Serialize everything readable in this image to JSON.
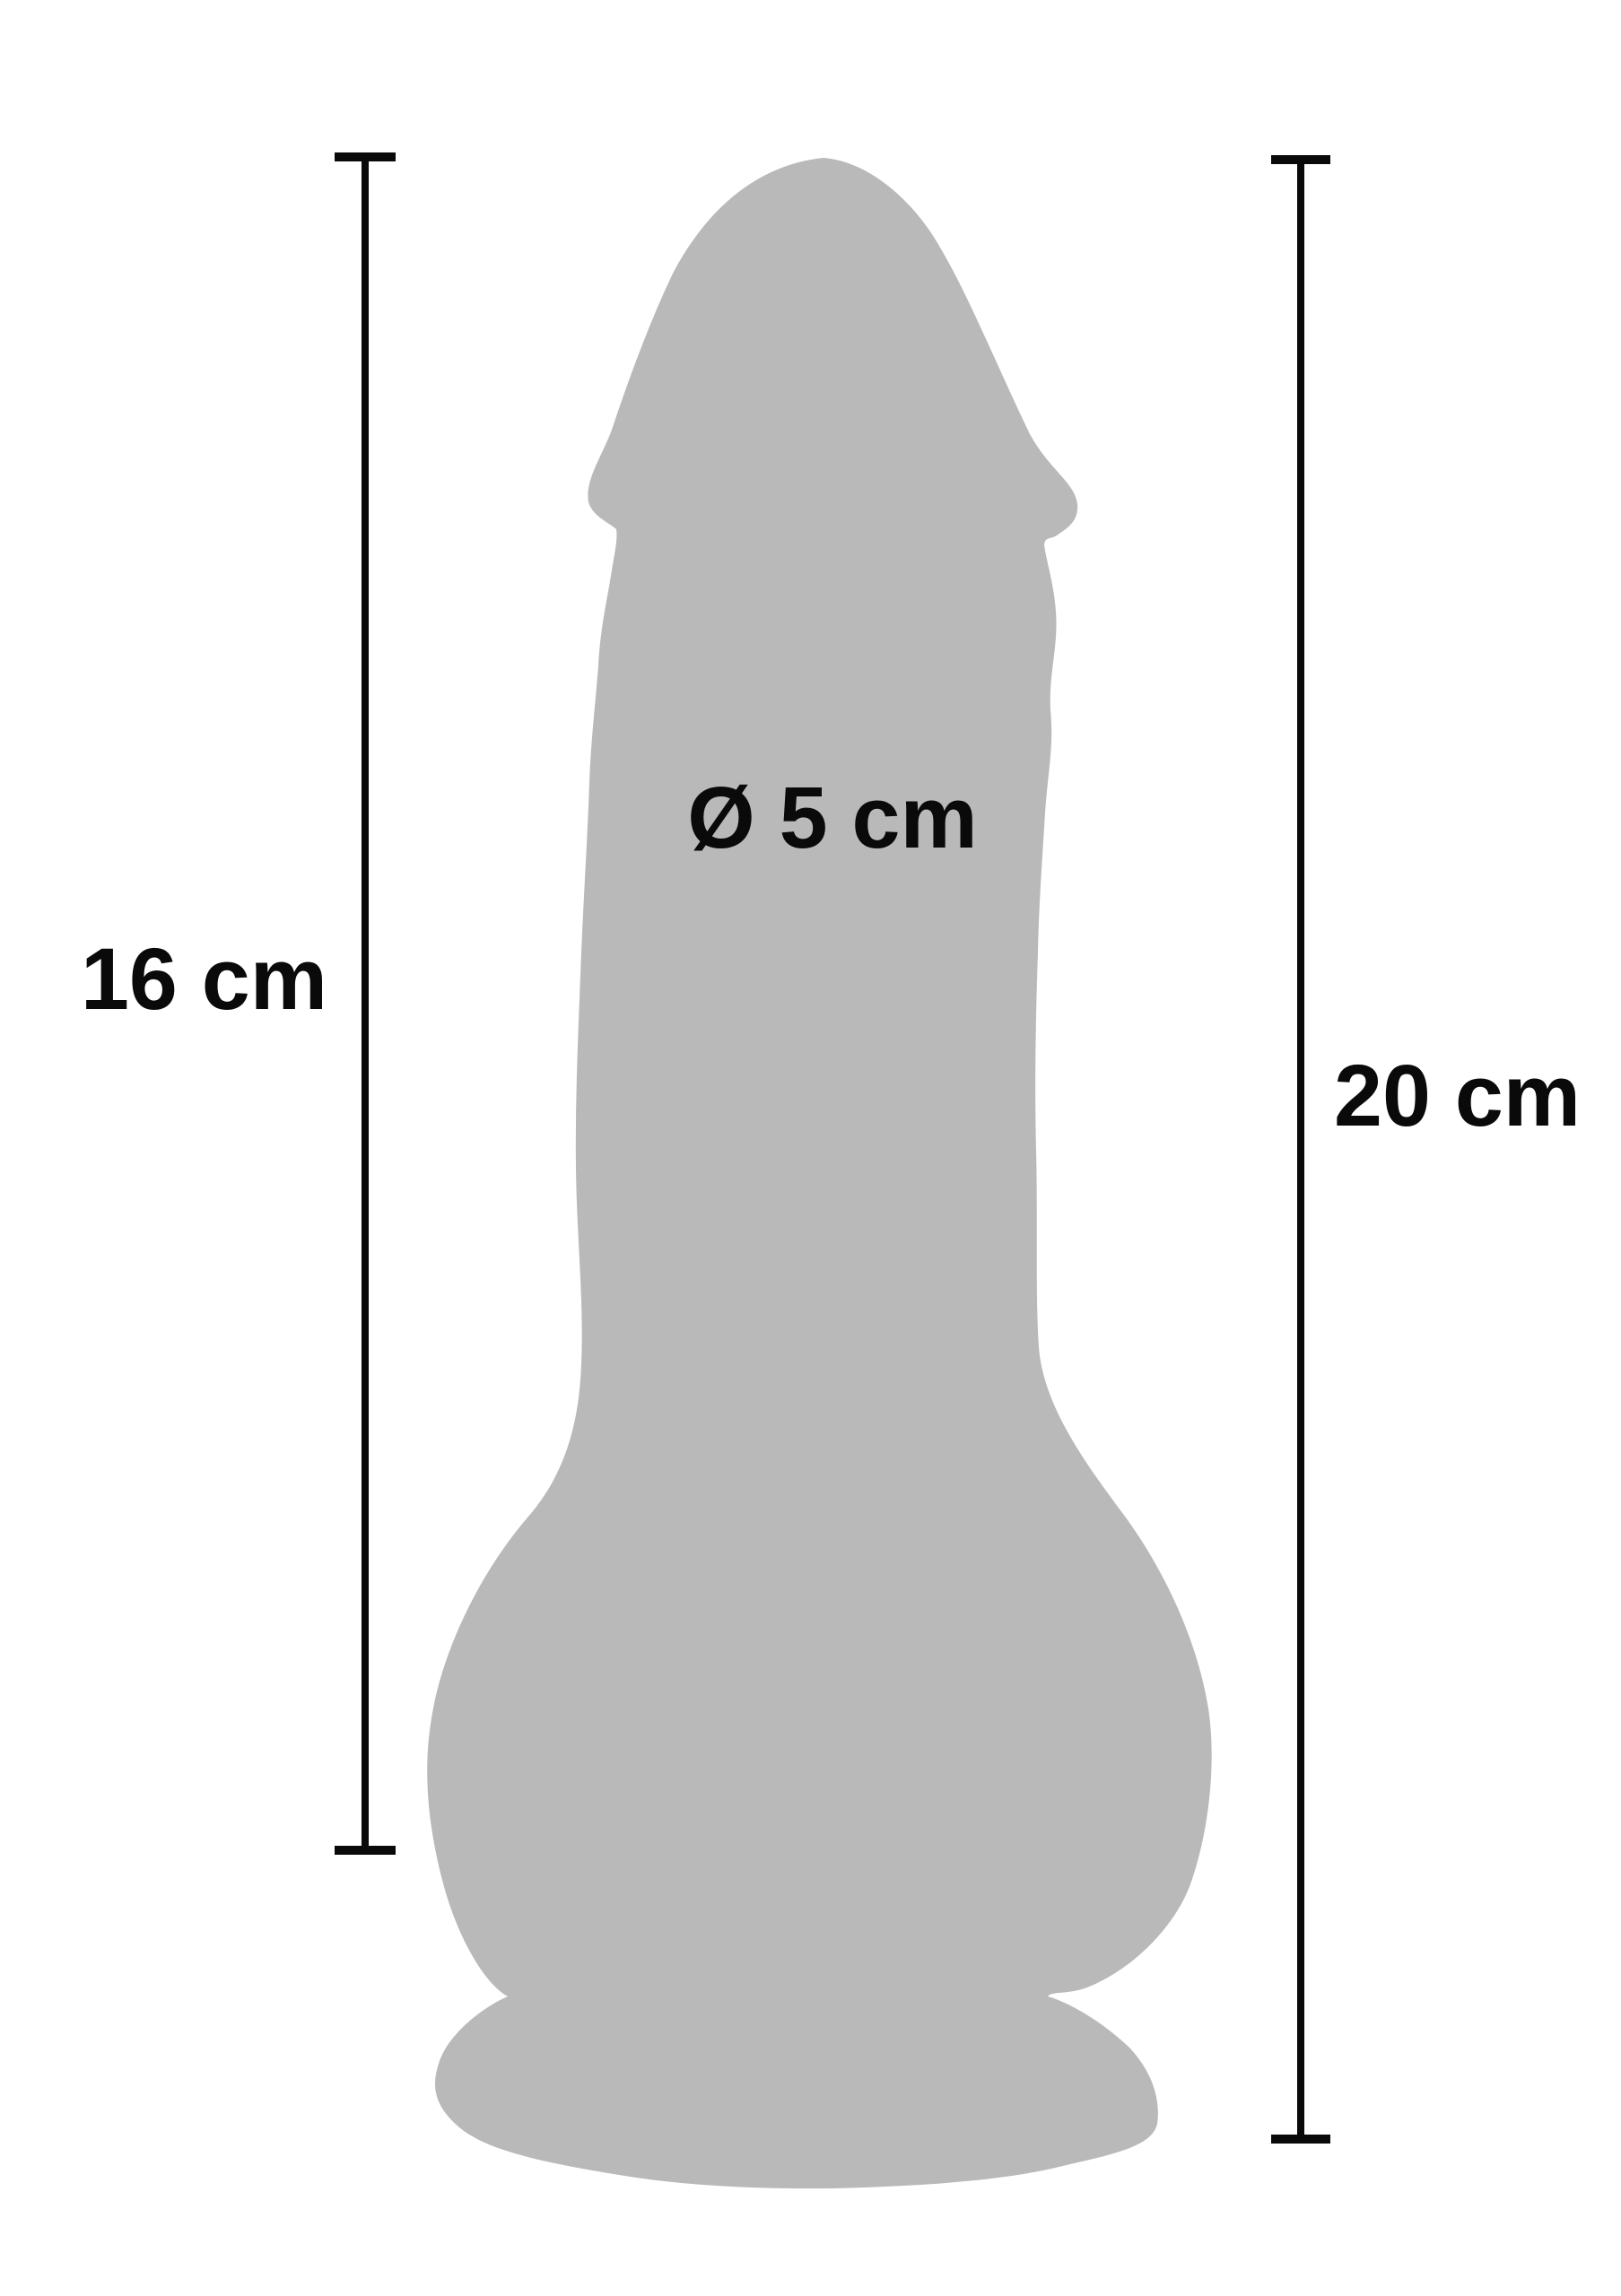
{
  "diagram": {
    "type": "product-dimension-diagram",
    "product": "realistic suction-cup dildo silhouette",
    "measurements": {
      "insertable_length": {
        "label": "16 cm",
        "side": "left"
      },
      "total_length": {
        "label": "20 cm",
        "side": "right"
      },
      "diameter": {
        "label": "Ø 5 cm",
        "position": "on-shaft"
      }
    }
  },
  "colors": {
    "background": "#ffffff",
    "silhouette": "#b9b9b9",
    "ink": "#0a0a0a"
  }
}
